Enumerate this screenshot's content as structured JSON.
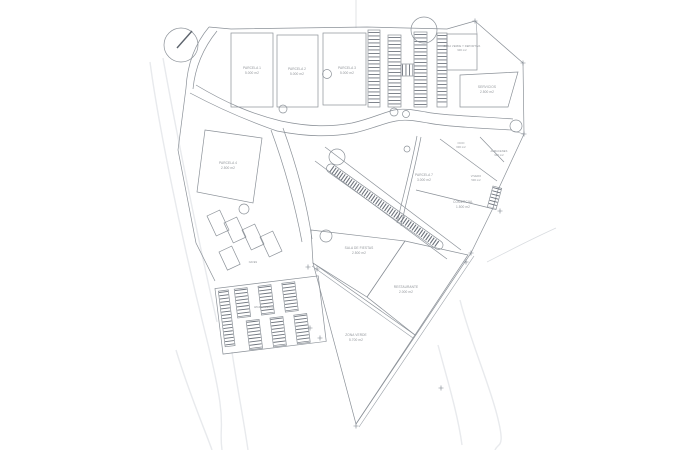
{
  "meta": {
    "drawing_type": "site plan / plano de parcelacion"
  },
  "colors": {
    "paper": "#ffffff",
    "ink": "#8b9198",
    "ink_dark": "#5d646d",
    "ink_faint": "#e8eaed",
    "text": "#8f9398"
  },
  "labels": {
    "parcela_1": {
      "l1": "PARCELA 1",
      "l2": "5.000 m2"
    },
    "parcela_2": {
      "l1": "PARCELA 2",
      "l2": "5.000 m2"
    },
    "parcela_3": {
      "l1": "PARCELA 3",
      "l2": "5.000 m2"
    },
    "zona_verde_deportiva": {
      "l1": "ZONA VERDE Y DEPORTIVA",
      "l2": "900 m2"
    },
    "servicios": {
      "l1": "SERVICIOS",
      "l2": "2.500 m2"
    },
    "ocio": {
      "l1": "OCIO",
      "l2": "600 m2"
    },
    "almacenes": {
      "l1": "ALMACENES",
      "l2": "900 m2"
    },
    "parcela_7": {
      "l1": "PARCELA 7",
      "l2": "3.000 m2"
    },
    "vivero": {
      "l1": "VIVERO",
      "l2": "500 m2"
    },
    "comercial": {
      "l1": "COMERCIAL",
      "l2": "1.500 m2"
    },
    "parcela_4": {
      "l1": "PARCELA 4",
      "l2": "2.500 m2"
    },
    "naves": {
      "l1": "NAVES"
    },
    "aparcamiento": {
      "l1": "APARCAMIENTO"
    },
    "sala_fiestas": {
      "l1": "SALA DE FIESTAS",
      "l2": "2.500 m2"
    },
    "restaurante": {
      "l1": "RESTAURANTE",
      "l2": "2.000 m2"
    },
    "zona_verde_sur": {
      "l1": "ZONA VERDE",
      "l2": "5.700 m2"
    }
  }
}
